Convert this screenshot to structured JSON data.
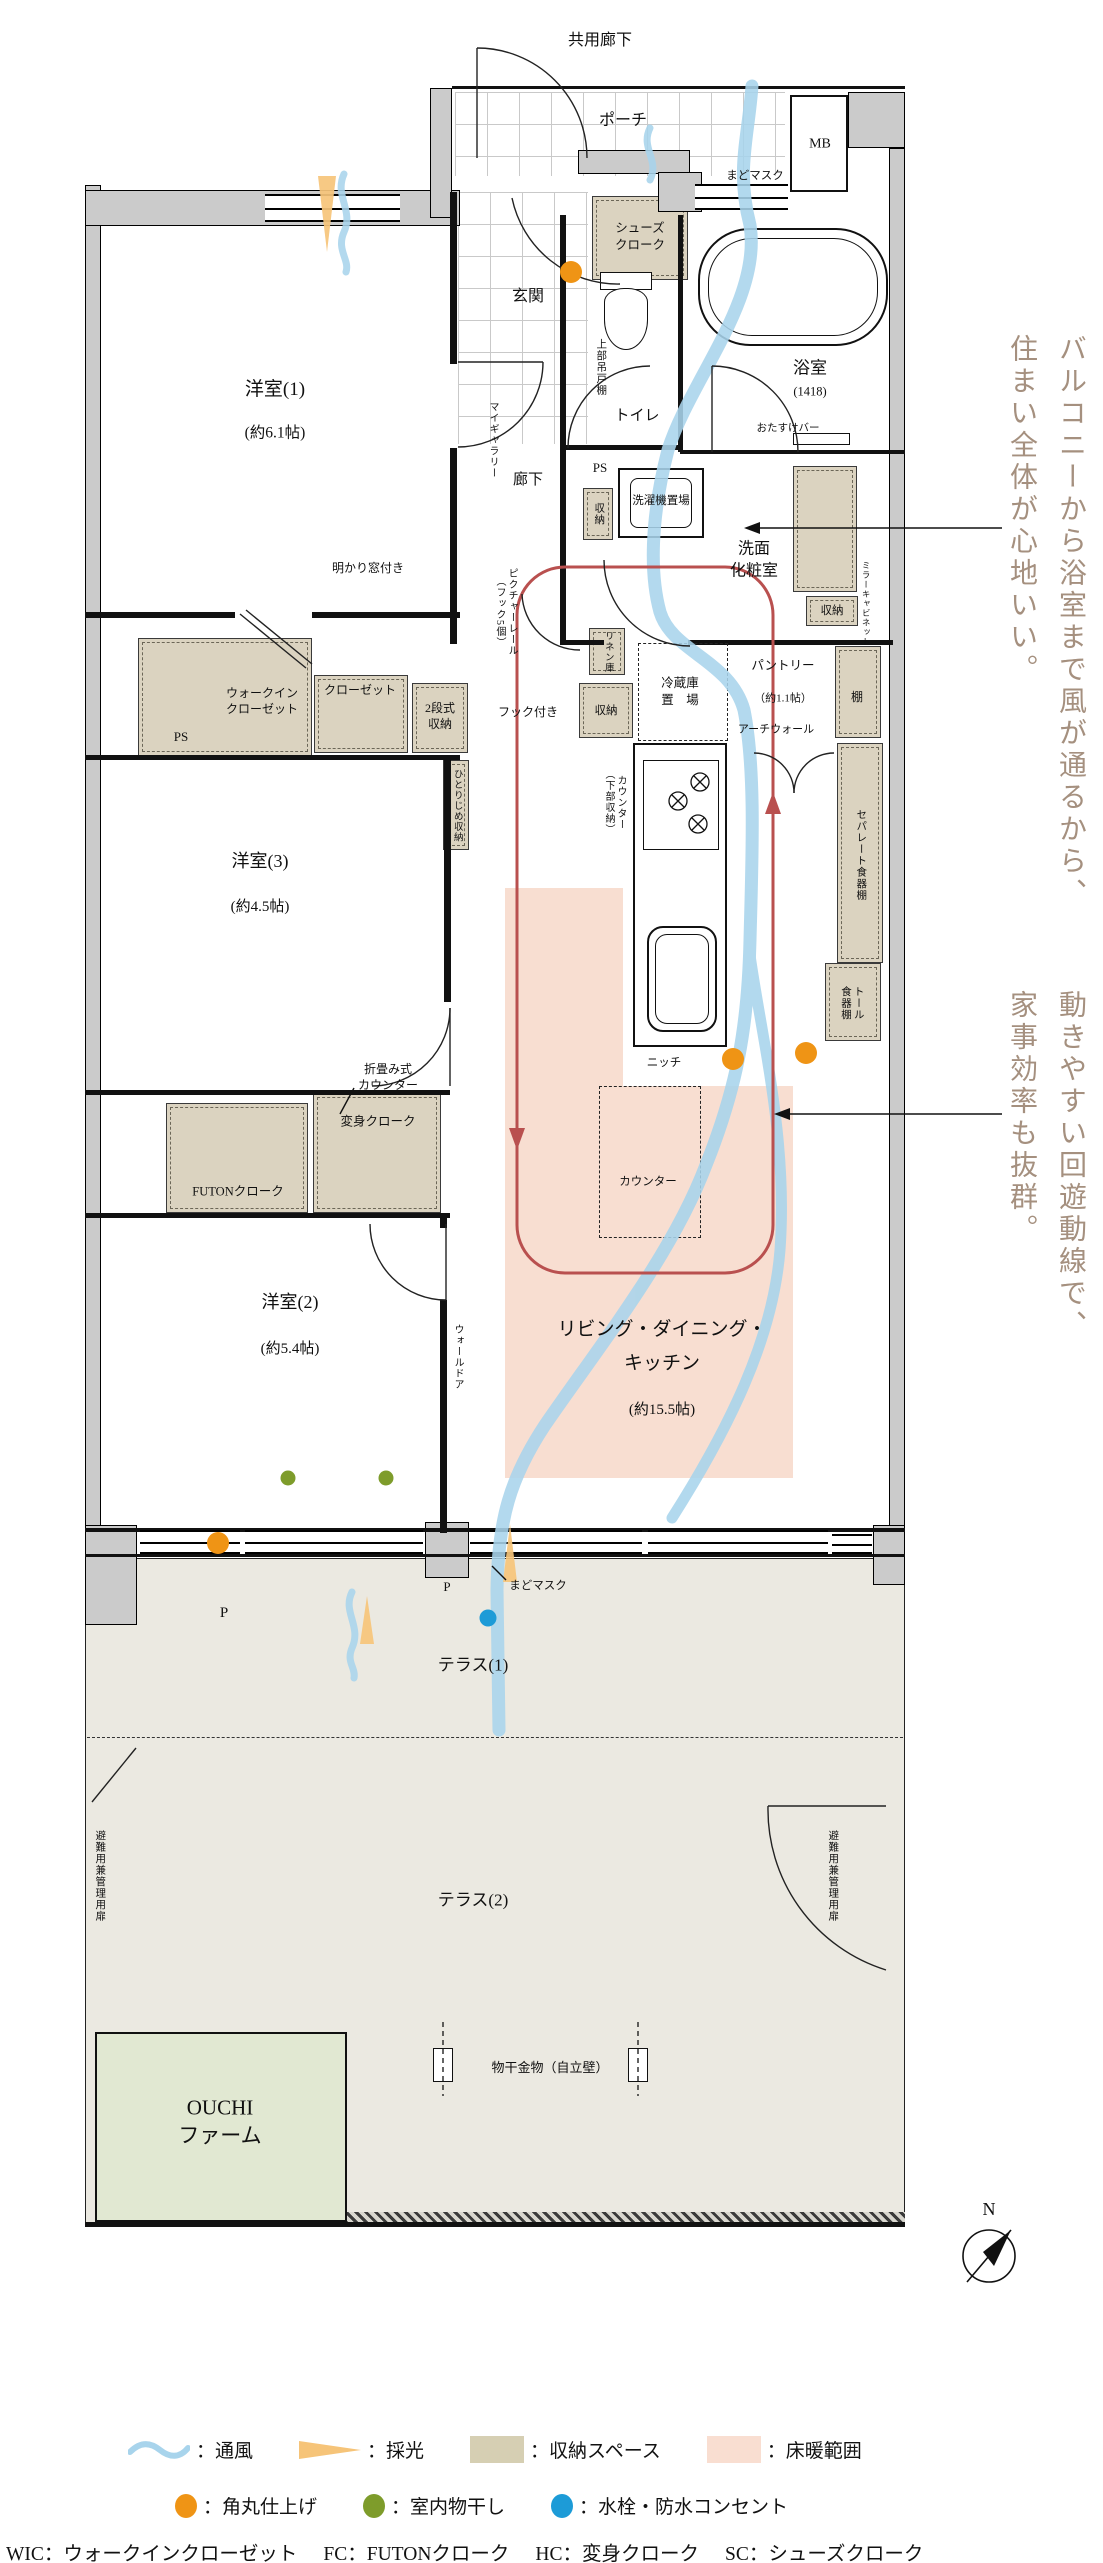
{
  "plan_title": "間取り図",
  "labels": [
    {
      "id": "common-corridor",
      "t": "共用廊下",
      "x": 600,
      "y": 41,
      "fs": 16
    },
    {
      "id": "porch",
      "t": "ポーチ",
      "x": 623,
      "y": 121,
      "fs": 16
    },
    {
      "id": "mb",
      "t": "MB",
      "x": 820,
      "y": 145,
      "fs": 14
    },
    {
      "id": "madomask-top",
      "t": "まどマスク",
      "x": 755,
      "y": 177,
      "fs": 11.5
    },
    {
      "id": "shoes-cloak",
      "t": "シューズ\nクローク",
      "x": 640,
      "y": 237,
      "fs": 12.5
    },
    {
      "id": "entrance",
      "t": "玄関",
      "x": 528,
      "y": 297,
      "fs": 16
    },
    {
      "id": "toilet",
      "t": "トイレ",
      "x": 637,
      "y": 416,
      "fs": 15
    },
    {
      "id": "upper-hanging-shelf",
      "t": "上部吊戸棚",
      "x": 600,
      "y": 367,
      "fs": 10.5,
      "v": 1
    },
    {
      "id": "bathroom",
      "t": "浴室",
      "x": 810,
      "y": 369,
      "fs": 17
    },
    {
      "id": "bathroom-size",
      "t": "(1418)",
      "x": 810,
      "y": 392,
      "fs": 12.5
    },
    {
      "id": "otasuke-bar",
      "t": "おたすけバー",
      "x": 788,
      "y": 429,
      "fs": 10.5
    },
    {
      "id": "bedroom1",
      "t": "洋室(1)",
      "x": 275,
      "y": 390,
      "fs": 19
    },
    {
      "id": "bedroom1-size",
      "t": "(約6.1帖)",
      "x": 275,
      "y": 434,
      "fs": 15.5
    },
    {
      "id": "my-gallery",
      "t": "マイギャラリー",
      "x": 492,
      "y": 440,
      "fs": 10,
      "v": 1
    },
    {
      "id": "hallway",
      "t": "廊下",
      "x": 528,
      "y": 480,
      "fs": 15
    },
    {
      "id": "ps-top",
      "t": "PS",
      "x": 600,
      "y": 468,
      "fs": 13
    },
    {
      "id": "storage-sanitary",
      "t": "収納",
      "x": 598,
      "y": 514,
      "fs": 10.5,
      "v": 1
    },
    {
      "id": "washer-space",
      "t": "洗濯機置場",
      "x": 661,
      "y": 502,
      "fs": 11.5
    },
    {
      "id": "powder-room",
      "t": "洗面\n化粧室",
      "x": 754,
      "y": 560,
      "fs": 16
    },
    {
      "id": "storage-vanity",
      "t": "収納",
      "x": 832,
      "y": 612,
      "fs": 11.5
    },
    {
      "id": "mirror-cabinet",
      "t": "ミラーキャビネット",
      "x": 866,
      "y": 604,
      "fs": 8.5,
      "v": 1
    },
    {
      "id": "akari-window",
      "t": "明かり窓付き",
      "x": 368,
      "y": 568,
      "fs": 12
    },
    {
      "id": "picture-rail",
      "t": "ピクチャーレール\n（フック5個）",
      "x": 505,
      "y": 612,
      "fs": 10,
      "v": 1
    },
    {
      "id": "walk-in-closet",
      "t": "ウォークイン\nクローゼット",
      "x": 262,
      "y": 701,
      "fs": 12
    },
    {
      "id": "closet",
      "t": "クローゼット",
      "x": 360,
      "y": 690,
      "fs": 12
    },
    {
      "id": "two-tier-storage",
      "t": "2段式\n収納",
      "x": 440,
      "y": 716,
      "fs": 12
    },
    {
      "id": "ps-left",
      "t": "PS",
      "x": 181,
      "y": 737,
      "fs": 13
    },
    {
      "id": "hook",
      "t": "フック付き",
      "x": 528,
      "y": 712,
      "fs": 12
    },
    {
      "id": "hitorijime-storage",
      "t": "ひとりじめ収納",
      "x": 456,
      "y": 806,
      "fs": 9.5,
      "v": 1
    },
    {
      "id": "linen",
      "t": "リネン庫",
      "x": 607,
      "y": 652,
      "fs": 9.5,
      "v": 1
    },
    {
      "id": "storage-kitchen",
      "t": "収納",
      "x": 606,
      "y": 712,
      "fs": 11.5
    },
    {
      "id": "fridge-space",
      "t": "冷蔵庫\n置　場",
      "x": 680,
      "y": 692,
      "fs": 12.5
    },
    {
      "id": "pantry",
      "t": "パントリー",
      "x": 783,
      "y": 666,
      "fs": 12.5
    },
    {
      "id": "pantry-size",
      "t": "（約1.1帖）",
      "x": 783,
      "y": 699,
      "fs": 11
    },
    {
      "id": "arch-wall",
      "t": "アーチウォール",
      "x": 776,
      "y": 730,
      "fs": 11
    },
    {
      "id": "shelf",
      "t": "棚",
      "x": 857,
      "y": 697,
      "fs": 12
    },
    {
      "id": "counter-lower-storage",
      "t": "カウンター\n（下部収納）",
      "x": 614,
      "y": 802,
      "fs": 10,
      "v": 1
    },
    {
      "id": "separate-cupboard",
      "t": "セパレート食器棚",
      "x": 860,
      "y": 855,
      "fs": 10.5,
      "v": 1
    },
    {
      "id": "tall-cupboard",
      "t": "トール\n食器棚",
      "x": 851,
      "y": 1003,
      "fs": 10.5,
      "v": 1
    },
    {
      "id": "niche",
      "t": "ニッチ",
      "x": 664,
      "y": 1064,
      "fs": 11.5
    },
    {
      "id": "folding-counter",
      "t": "折畳み式\nカウンター",
      "x": 388,
      "y": 1077,
      "fs": 12
    },
    {
      "id": "henshin-cloak",
      "t": "変身クローク",
      "x": 378,
      "y": 1122,
      "fs": 12.5
    },
    {
      "id": "bedroom3",
      "t": "洋室(3)",
      "x": 260,
      "y": 861,
      "fs": 18
    },
    {
      "id": "bedroom3-size",
      "t": "(約4.5帖)",
      "x": 260,
      "y": 907,
      "fs": 15
    },
    {
      "id": "futon-cloak",
      "t": "FUTONクローク",
      "x": 238,
      "y": 1192,
      "fs": 12.5
    },
    {
      "id": "bedroom2",
      "t": "洋室(2)",
      "x": 290,
      "y": 1302,
      "fs": 18
    },
    {
      "id": "bedroom2-size",
      "t": "(約5.4帖)",
      "x": 290,
      "y": 1349,
      "fs": 15
    },
    {
      "id": "wall-door",
      "t": "ウォールドア",
      "x": 457,
      "y": 1357,
      "fs": 10,
      "v": 1
    },
    {
      "id": "ldk",
      "t": "リビング・ダイニング・\nキッチン",
      "x": 662,
      "y": 1347,
      "fs": 19,
      "lh": 1.8
    },
    {
      "id": "ldk-size",
      "t": "(約15.5帖)",
      "x": 662,
      "y": 1410,
      "fs": 15
    },
    {
      "id": "counter-island",
      "t": "カウンター",
      "x": 648,
      "y": 1183,
      "fs": 11.5
    },
    {
      "id": "pillar-p1",
      "t": "P",
      "x": 224,
      "y": 1613,
      "fs": 15
    },
    {
      "id": "pillar-p2",
      "t": "P",
      "x": 447,
      "y": 1587,
      "fs": 13
    },
    {
      "id": "madomask-bottom",
      "t": "まどマスク",
      "x": 538,
      "y": 1587,
      "fs": 11.5
    },
    {
      "id": "terrace1",
      "t": "テラス(1)",
      "x": 473,
      "y": 1666,
      "fs": 17
    },
    {
      "id": "terrace2",
      "t": "テラス(2)",
      "x": 473,
      "y": 1901,
      "fs": 17
    },
    {
      "id": "escape-door-left",
      "t": "避難用兼管理用扉",
      "x": 99,
      "y": 1876,
      "fs": 10.5,
      "v": 1
    },
    {
      "id": "escape-door-right",
      "t": "避難用兼管理用扉",
      "x": 832,
      "y": 1876,
      "fs": 10.5,
      "v": 1
    },
    {
      "id": "ouchi-farm",
      "t": "OUCHI\nファーム",
      "x": 220,
      "y": 2122,
      "fs": 21
    },
    {
      "id": "monohoshi",
      "t": "物干金物（自立壁）",
      "x": 550,
      "y": 2068,
      "fs": 13
    },
    {
      "id": "compass-n",
      "t": "N",
      "x": 989,
      "y": 2209,
      "fs": 18
    }
  ],
  "side_notes": {
    "note1": {
      "lines": [
        "バルコニーから浴室まで風が通るから、",
        "住まい全体が心地いい。"
      ]
    },
    "note2": {
      "lines": [
        "動きやすい回遊動線で、",
        "家事効率も抜群。"
      ]
    }
  },
  "legend": {
    "row1": [
      {
        "symbol": "wave",
        "label": "：通風"
      },
      {
        "symbol": "light-triangle",
        "label": "：採光"
      },
      {
        "symbol": "storage-swatch",
        "label": "：収納スペース"
      },
      {
        "symbol": "floor-heating-swatch",
        "label": "：床暖範囲"
      }
    ],
    "row2": [
      {
        "symbol": "orange-dot",
        "label": "：角丸仕上げ",
        "color": "#ef9415"
      },
      {
        "symbol": "green-dot",
        "label": "：室内物干し",
        "color": "#7e9c2b"
      },
      {
        "symbol": "blue-dot",
        "label": "：水栓・防水コンセント",
        "color": "#1d9bd7"
      }
    ],
    "abbreviations": [
      {
        "abbr": "WIC",
        "label": "：ウォークインクローゼット"
      },
      {
        "abbr": "FC",
        "label": "：FUTONクローク"
      },
      {
        "abbr": "HC",
        "label": "：変身クローク"
      },
      {
        "abbr": "SC",
        "label": "：シューズクローク"
      }
    ]
  },
  "colors": {
    "wind": "#a8d4ec",
    "light": "#f6c479",
    "storage": "#dbd3c0",
    "floor_heating": "#f8ded1",
    "circulation": "#b9504f",
    "note_text": "#a5907f",
    "dot_orange": "#ef9415",
    "dot_green": "#7e9c2b",
    "dot_blue": "#1d9bd7"
  }
}
